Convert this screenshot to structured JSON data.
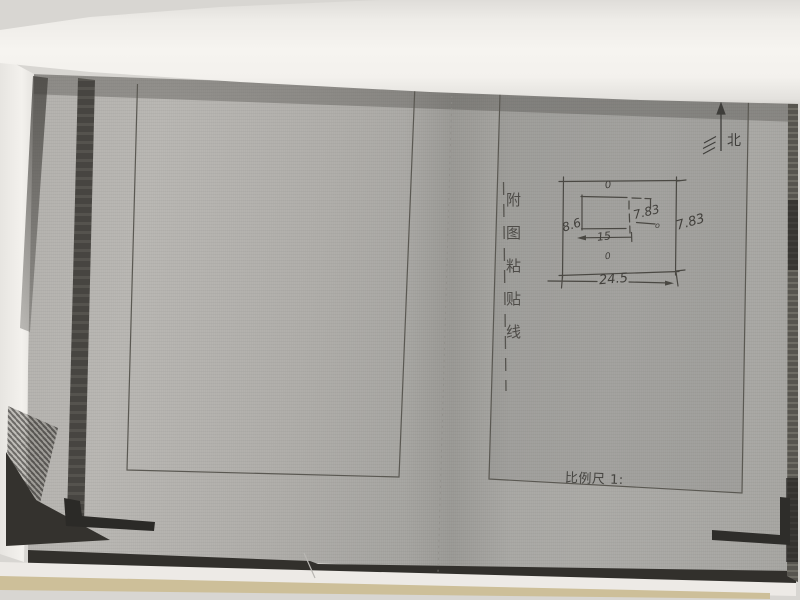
{
  "page": {
    "north_label": "北",
    "paste_line_chars": [
      "附",
      "图",
      "粘",
      "贴",
      "线"
    ],
    "scale_label": "比例尺 1:"
  },
  "sketch": {
    "width_total": "24.5",
    "height_right_outer": "7.83",
    "height_right_inner": "7.83",
    "width_inner": "15",
    "height_left": "8.6",
    "mark_top": "0",
    "mark_right": "o",
    "mark_bottom": "0"
  }
}
